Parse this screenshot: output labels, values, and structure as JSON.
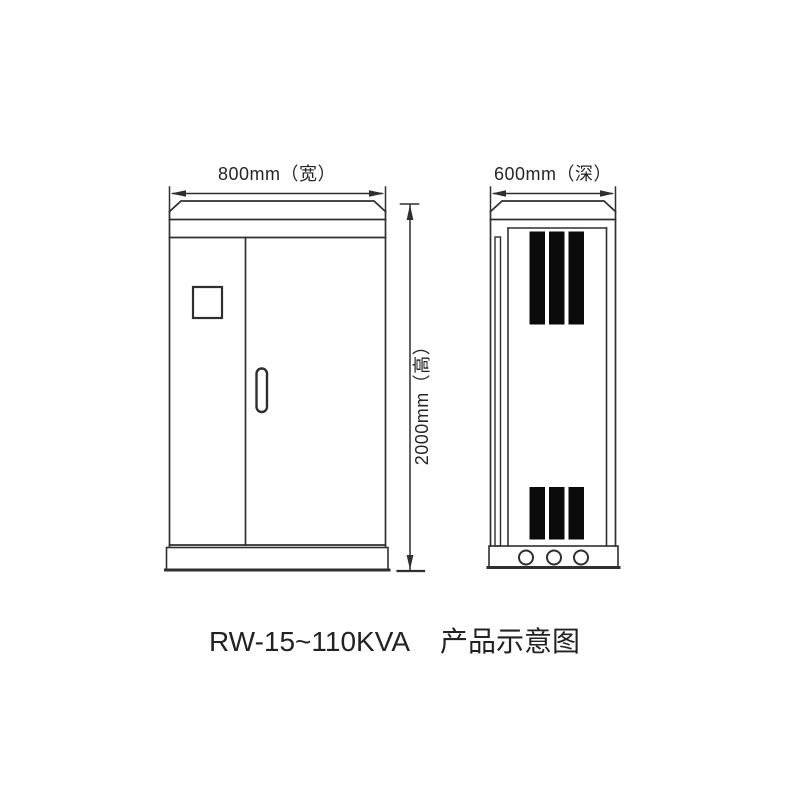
{
  "page": {
    "background_color": "#ffffff",
    "line_color": "#2f2f2f",
    "vent_fill_color": "#0a0a0a",
    "text_color": "#262626"
  },
  "diagram": {
    "front_view": {
      "width_label": "800mm（宽）",
      "height_label": "2000mm（高）",
      "door_count": 2,
      "window_count": 1,
      "handle_count": 1
    },
    "side_view": {
      "depth_label": "600mm（深）",
      "top_vent_bar_count": 3,
      "bottom_vent_bar_count": 3,
      "base_hole_count": 3
    },
    "caption": {
      "model": "RW-15~110KVA",
      "title": "产品示意图"
    }
  }
}
